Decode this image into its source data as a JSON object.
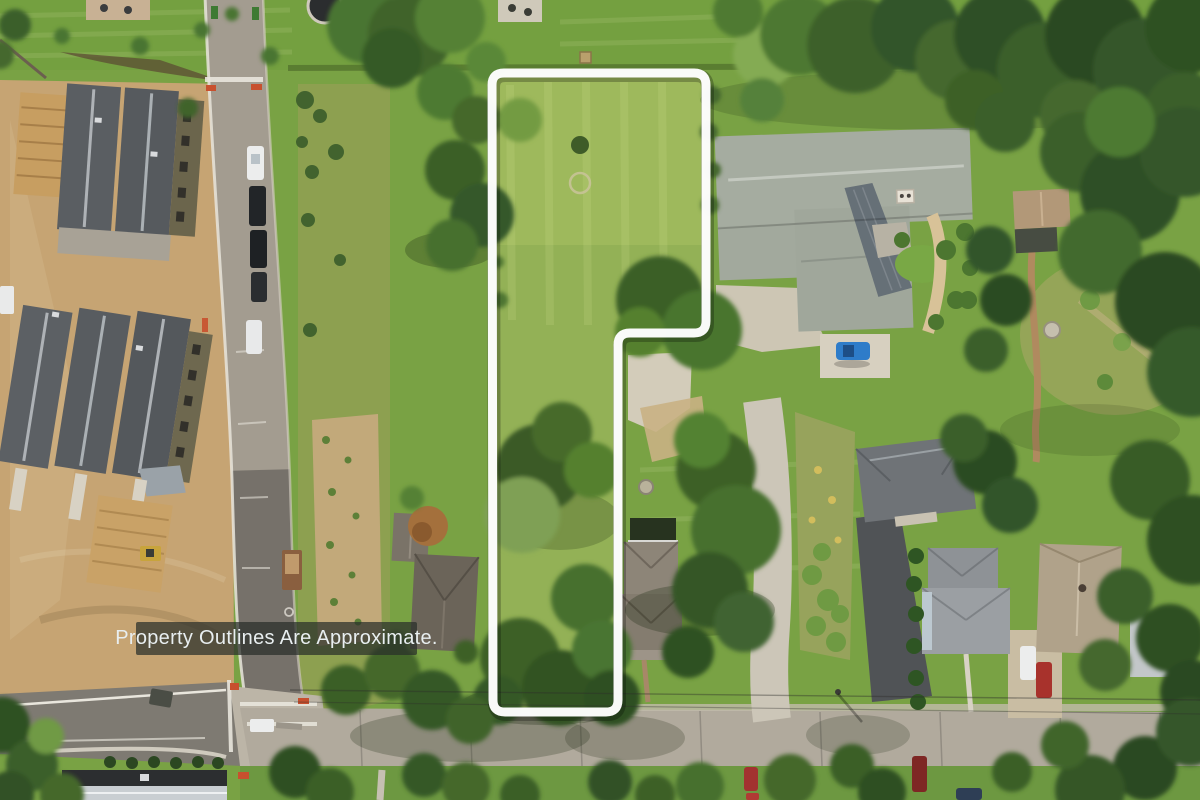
{
  "meta": {
    "image_type": "aerial-drone-photo",
    "subject": "vacant land real-estate listing with property boundary overlay"
  },
  "overlay": {
    "disclaimer": "Property Outlines Are Approximate.",
    "banner_bg": "rgba(40,46,42,0.72)",
    "text_color": "#e8eef0"
  },
  "property_outline": {
    "stroke_color": "#ffffff",
    "stroke_width": 9,
    "corner_radius": 12,
    "shadow_color": "rgba(0,0,0,0.25)",
    "points": [
      [
        492,
        73
      ],
      [
        706,
        73
      ],
      [
        706,
        333
      ],
      [
        618,
        333
      ],
      [
        618,
        712
      ],
      [
        493,
        712
      ]
    ]
  },
  "palette": {
    "grass": "#79a244",
    "parcel_lawn": "#93b156",
    "dirt": "#c6a473",
    "scrub": "#8da050",
    "concrete_road": "#a39c90",
    "asphalt_old": "#7e7a72",
    "main_road": "#b1aa9d",
    "townhouse_roof": "#5a5e62",
    "estate_roof": "#a5aca0",
    "estate_metal_roof": "#667077",
    "tree_dark": "#2f5024",
    "tree_light": "#84ab53",
    "car_blue": "#2e7cc9",
    "car_red": "#a8322c",
    "car_white": "#eceded",
    "marker_red": "#c8502e"
  },
  "scene_inventory": [
    "construction site with townhouses and lumber piles (left)",
    "new concrete access road with parked cars (left)",
    "outlined vacant parcel with lawn and mature trees (center)",
    "large estate house with courtyard and blue car (upper right)",
    "neighboring houses with driveways and parked cars (lower right)",
    "main road with utility lines (bottom)",
    "dense tree canopy (top right and right edge)"
  ]
}
